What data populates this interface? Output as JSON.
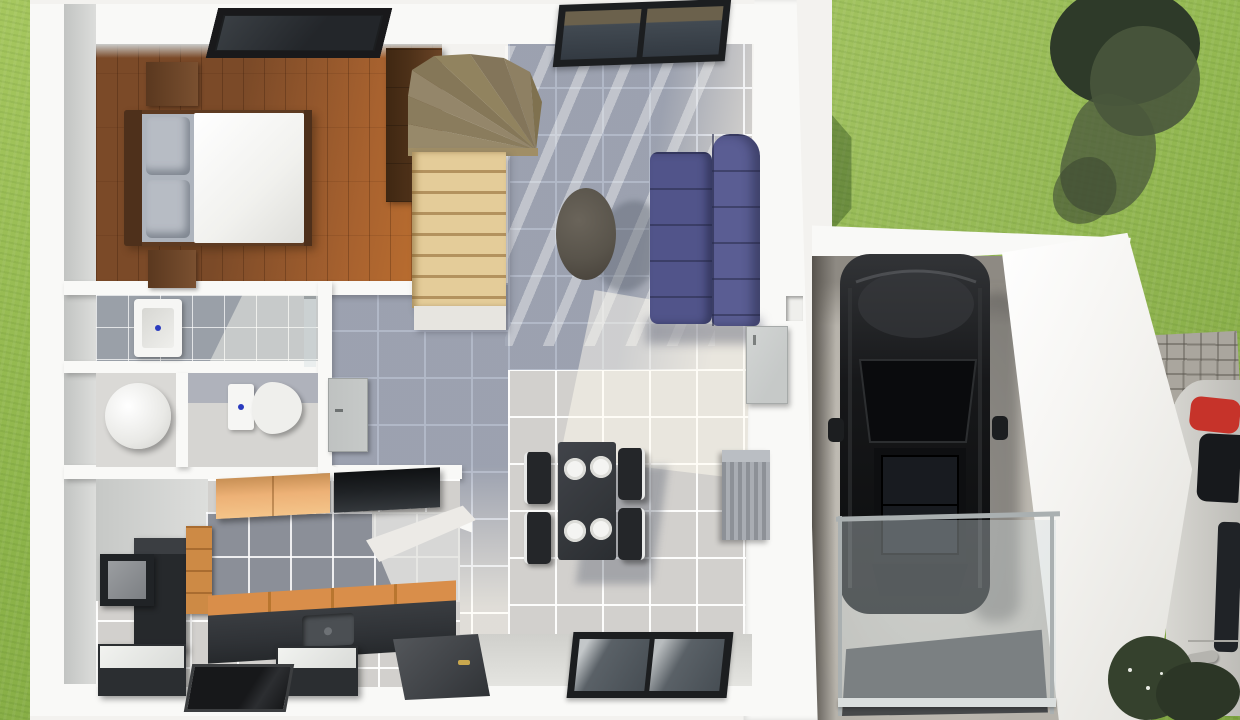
{
  "image_type": "3d-architectural-floor-plan-render-top-view",
  "visible_text": [],
  "palette": {
    "grass1": "#8db44a",
    "grass2": "#a6c75f",
    "grass3": "#7da33f",
    "treedark": "#2e3a29",
    "treemid": "#49573c",
    "plot": "#f3f2ef",
    "wall": "#f9f9f7",
    "face": "#cfd1cf",
    "face2": "#e6e6e4",
    "wood": "#7b4a28",
    "woodlight": "#a8622f",
    "woodhot": "#c0712f",
    "wardrobe": "#4c3018",
    "bedframe": "#5e3b22",
    "pillow": "#b7bcc4",
    "duvet": "#f1f1ee",
    "stair1": "#e4cc99",
    "stair2": "#b3925e",
    "winder": "#8f8160",
    "tile": "#d2d0cd",
    "tileshadow": "rgba(102,115,146,0.5)",
    "sun": "rgba(255,252,240,0.5)",
    "bathtile": "#9aa0a8",
    "fixture": "#f6f6f4",
    "bluedot": "#2a3bbf",
    "sofa1": "#51548a",
    "sofa2": "#5a5d93",
    "coffeetable": "#59544b",
    "tabledark": "#34373b",
    "chair": "#242629",
    "plate": "#f4f4f2",
    "sb1": "#8d9197",
    "sb2": "#a9adb3",
    "kdark": "#2f3236",
    "korange": "#cd8a45",
    "korangelight": "#edb176",
    "kblack": "#1f2225",
    "counterorange": "#d98e4a",
    "backsplash": "#8b8f98",
    "concrete": "#b6b2aa",
    "concreteshadow": "#8e8a83",
    "carblack": "#141517",
    "carglass": "#101114",
    "roof": "#f4f3f0",
    "cobble": "#aaa69e",
    "matdark": "#46484a",
    "railframe": "#aab0b1",
    "whitecar": "#d8d7d2",
    "redaccent": "#c6332a",
    "shrub": "#35412d",
    "doorgray": "#c6c9c8",
    "doordark": "#3f4246",
    "winframe": "#1c1e20",
    "winglass": "#424a52"
  },
  "scene": {
    "exterior": {
      "items": [
        "lawn",
        "tree",
        "house-shadow",
        "stone-path",
        "white-parked-car",
        "shrubs",
        "walkway"
      ]
    },
    "house": {
      "bedroom": [
        "wood-floor",
        "double-bed",
        "pillows",
        "duvet",
        "headboard",
        "nightstand-top",
        "nightstand-bottom",
        "wardrobe",
        "skylight-window"
      ],
      "staircase": [
        "winder-steps",
        "straight-flight",
        "landing"
      ],
      "living_room": [
        "tile-floor",
        "purple-sofa",
        "round-coffee-table",
        "north-window",
        "sunlight-stripes"
      ],
      "dining": [
        "dining-table",
        "four-plates",
        "four-chairs",
        "ribbed-sideboard"
      ],
      "bathrooms": [
        "utility-room",
        "washbasin",
        "shower-glass",
        "round-fixture",
        "toilet",
        "bathroom-door"
      ],
      "kitchen": [
        "upper-cabinet-orange",
        "upper-cabinet-black",
        "backsplash-tiles",
        "fridge-unit",
        "orange-drawers",
        "wall-screen",
        "counter-with-sink",
        "white-peninsula",
        "island-unit-1",
        "island-unit-2",
        "glass-floor-panel"
      ],
      "entry": [
        "entry-door",
        "south-window",
        "garage-side-door",
        "wall-niche"
      ]
    },
    "garage": {
      "items": [
        "concrete-floor",
        "black-car",
        "sunroof",
        "glass-railing",
        "driveway-mat",
        "angled-white-roof"
      ]
    }
  }
}
